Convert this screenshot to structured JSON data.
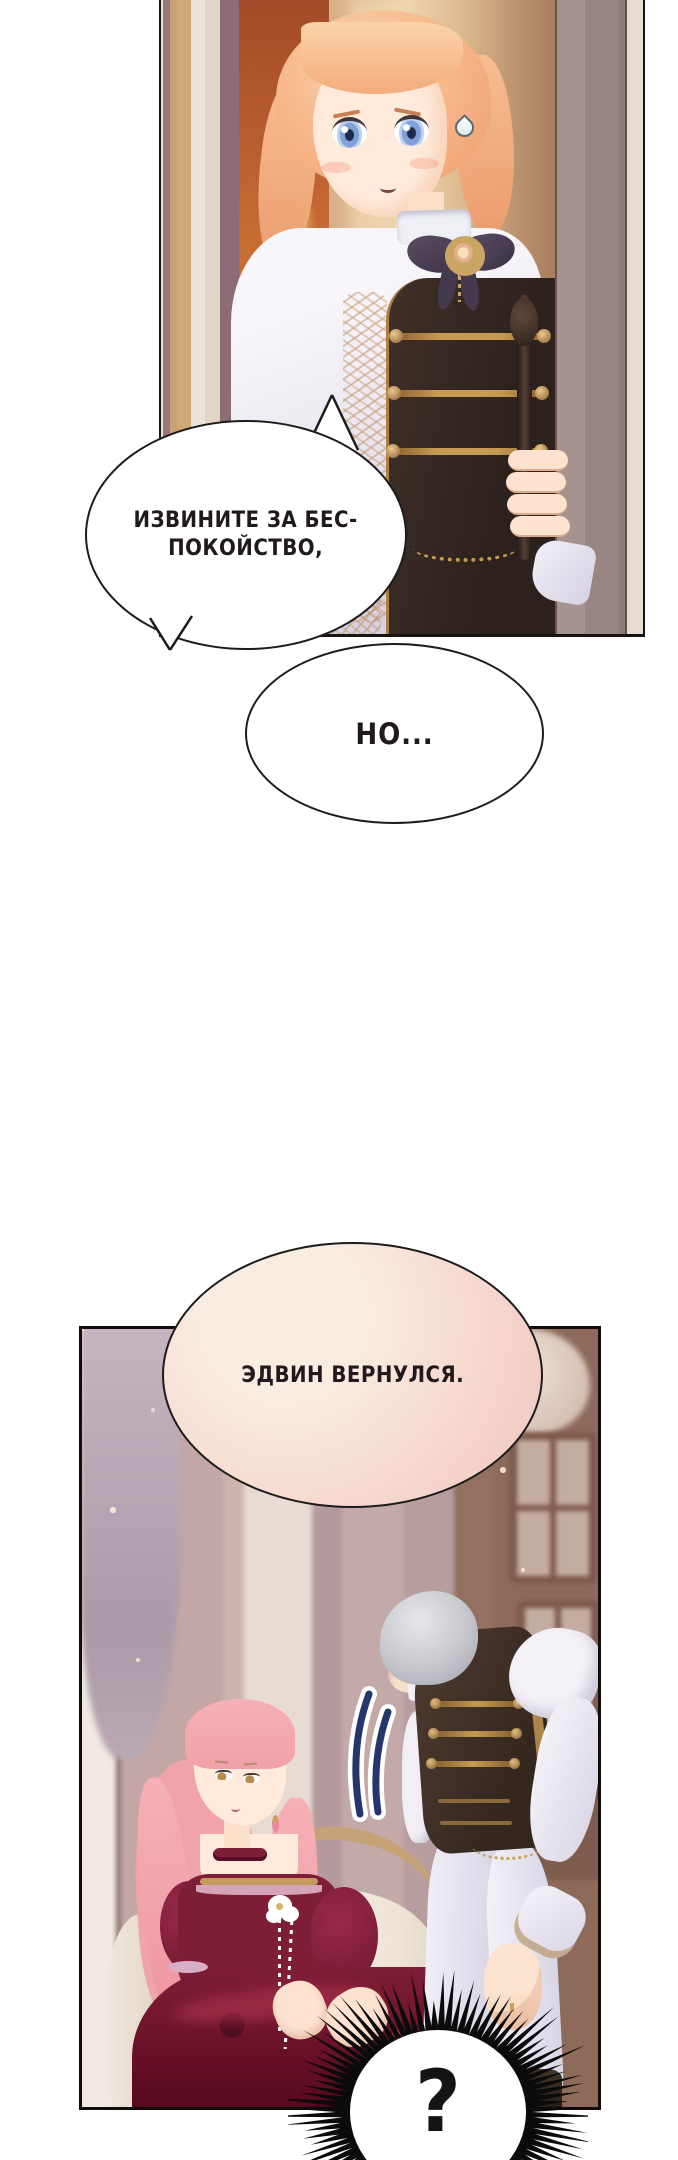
{
  "page": {
    "width": 678,
    "height": 2160,
    "background": "#ffffff",
    "kind": "manhwa-page"
  },
  "colors": {
    "ink": "#1c1c1c",
    "speech_bubble_fill": "#ffffff",
    "dialog_text": "#201a1d",
    "pink_bubble_light": "#f9ece1",
    "pink_bubble_deep": "#f2c6c2",
    "sigh_mark_blue": "#24366b",
    "burst_fill": "#0b0b0b",
    "burst_inner": "#ffffff"
  },
  "dialog": {
    "bubble1": {
      "line1": "ИЗВИНИТЕ ЗА БЕС-",
      "line2": "ПОКОЙСТВО,"
    },
    "bubble2": {
      "text": "НО..."
    },
    "bubble3": {
      "text": "ЭДВИН ВЕРНУЛСЯ."
    },
    "burst": {
      "text": "?"
    }
  },
  "icons": {
    "sweat_drop": "sweat-drop-icon",
    "sigh_mark": "sigh-dash-icon",
    "question_burst": "question-burst-icon"
  }
}
